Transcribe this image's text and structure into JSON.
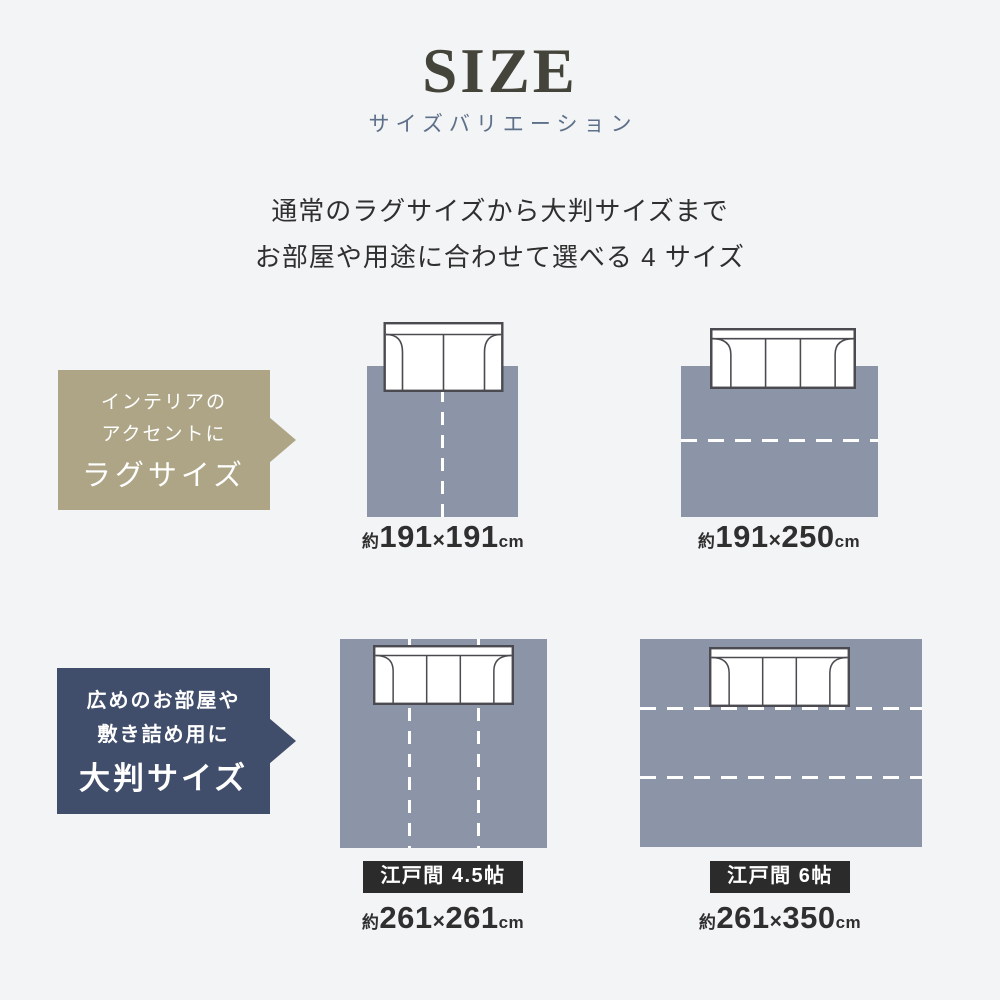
{
  "header": {
    "title": "SIZE",
    "subtitle": "サイズバリエーション",
    "description": {
      "line1": "通常のラグサイズから大判サイズまで",
      "line2": "お部屋や用途に合わせて選べる 4 サイズ"
    }
  },
  "badges": {
    "rug": {
      "line1": "インテリアの",
      "line2": "アクセントに",
      "title": "ラグサイズ"
    },
    "large": {
      "line1": "広めのお部屋や",
      "line2": "敷き詰め用に",
      "title": "大判サイズ"
    }
  },
  "rugs": [
    {
      "prefix": "約",
      "width": "191",
      "times": "×",
      "depth": "191",
      "unit": "cm"
    },
    {
      "prefix": "約",
      "width": "191",
      "times": "×",
      "depth": "250",
      "unit": "cm"
    },
    {
      "tag": "江戸間 4.5帖",
      "prefix": "約",
      "width": "261",
      "times": "×",
      "depth": "261",
      "unit": "cm"
    },
    {
      "tag": "江戸間 6帖",
      "prefix": "約",
      "width": "261",
      "times": "×",
      "depth": "350",
      "unit": "cm"
    }
  ],
  "colors": {
    "background": "#f3f4f6",
    "rug_fill": "#8b95a7",
    "badge_tan": "#ada586",
    "badge_navy": "#404e6b",
    "tag_bg": "#2b2b2b",
    "title_text": "#44443a",
    "subtitle_text": "#5e7089",
    "body_text": "#2f2f2f",
    "sofa_outline": "#4a4a50"
  }
}
